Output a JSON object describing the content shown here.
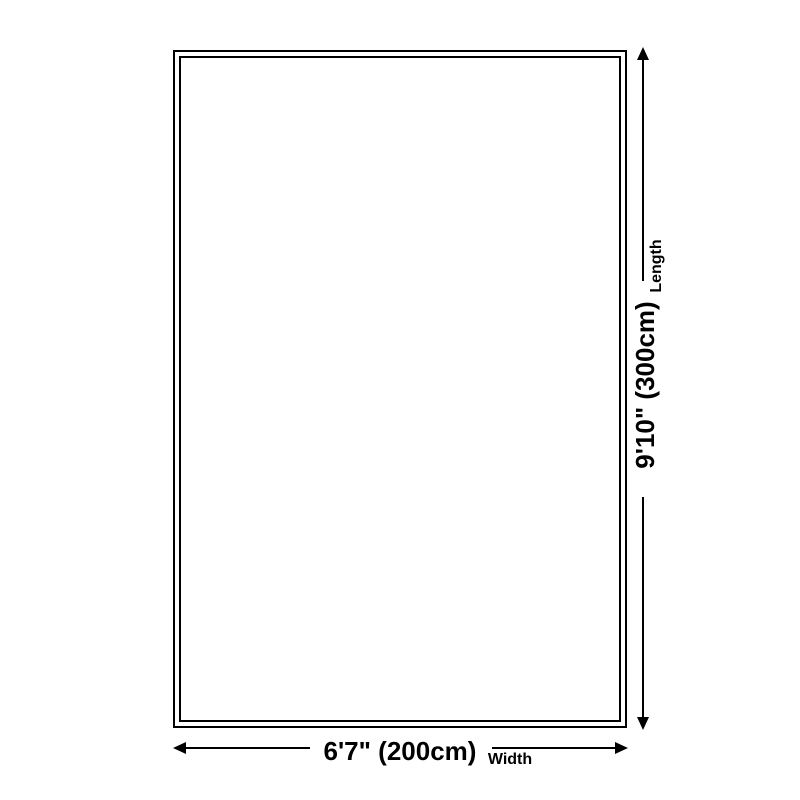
{
  "dimensions": {
    "length": {
      "value": "9'10\" (300cm)",
      "axis": "Length"
    },
    "width": {
      "value": "6'7\" (200cm)",
      "axis": "Width"
    }
  },
  "colors": {
    "background": "#ffffff",
    "line": "#000000",
    "text": "#000000"
  }
}
